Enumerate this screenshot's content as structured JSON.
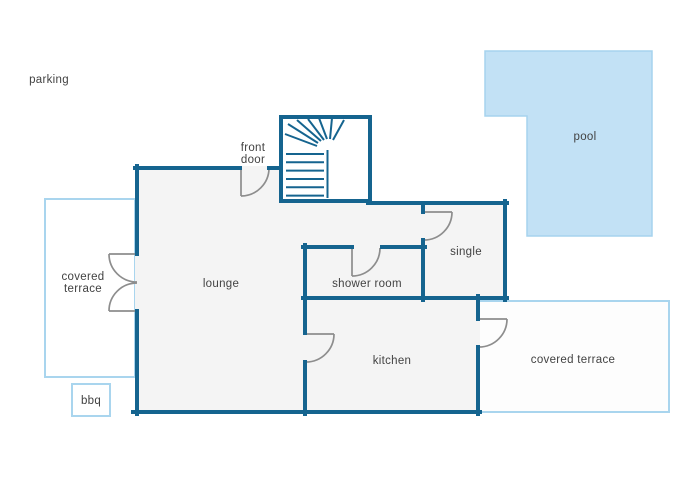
{
  "colors": {
    "wall": "#15648f",
    "accent_light": "#a9d5ee",
    "pool_fill": "#c2e1f5",
    "pool_border": "#a6d3ee",
    "interior": "#f4f4f4",
    "door": "#8d8d8d",
    "text": "#424242",
    "background": "#ffffff"
  },
  "labels": {
    "parking": "parking",
    "front_door_line1": "front",
    "front_door_line2": "door",
    "terrace_left_line1": "covered",
    "terrace_left_line2": "terrace",
    "lounge": "lounge",
    "shower_room": "shower room",
    "single": "single",
    "kitchen": "kitchen",
    "terrace_right": "covered terrace",
    "bbq": "bbq",
    "pool": "pool"
  }
}
